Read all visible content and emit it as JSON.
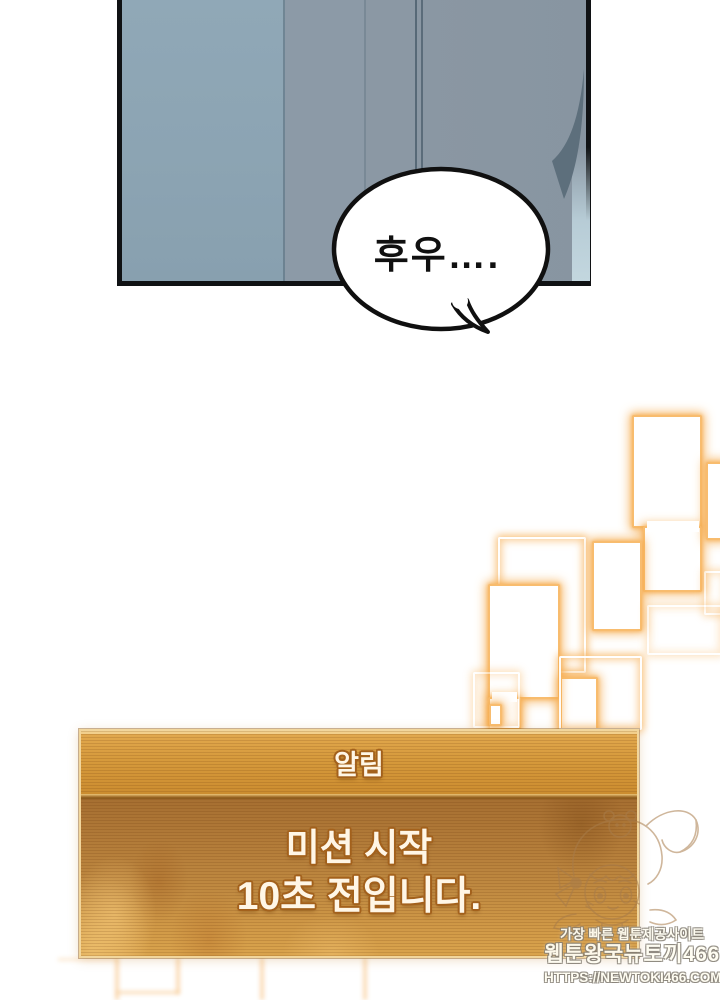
{
  "comic": {
    "speech_bubble": {
      "text": "후우…."
    }
  },
  "notification": {
    "title": "알림",
    "message_line1": "미션 시작",
    "message_line2": "10초 전입니다."
  },
  "watermark": {
    "tagline": "가장 빠른 웹툰제공사이트",
    "site_name": "웹툰왕국뉴토끼466",
    "url": "HTTPS://NEWTOKI466.COM"
  },
  "colors": {
    "panel_blue": "#8da4b3",
    "panel_shadow_shape": "#5d6f7c",
    "outline_black": "#101214",
    "glow_orange": "#f6ae52",
    "notif_header_top": "#e3aa50",
    "notif_header_bottom": "#cc8d30",
    "notif_body_top": "#a66f31",
    "notif_body_bottom": "#daa44d",
    "notif_text": "#fff6e6",
    "notif_text_outline": "#a3611c"
  }
}
